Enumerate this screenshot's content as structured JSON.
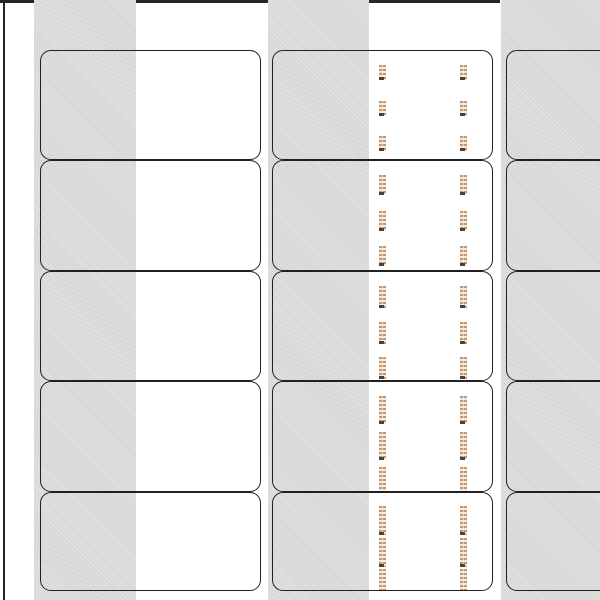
{
  "document": {
    "kind": "blank-label-sheet-template-preview",
    "page_background": "#ffffff"
  },
  "page_edges": {
    "left_line_color": "#262626",
    "top_line_color": "#1e1e1e"
  },
  "shading_bands": {
    "color": "#d5d5d5",
    "count": 3
  },
  "label_grid": {
    "columns_visible": 3,
    "rows_visible": 5,
    "border_color": "#202020",
    "corner_style": "rounded",
    "label_fill_outside_band": "#ffffff"
  },
  "label_content": {
    "content_column_index": 1,
    "thumbnail_columns_per_label": 2,
    "thumbnail_rows_per_label": 3,
    "thumbnails_per_label": 6,
    "thumbnail_color": "#c6976b",
    "thumbnail_background": "#f1e9e0",
    "thumbnail_foot_color": "#49423c"
  }
}
